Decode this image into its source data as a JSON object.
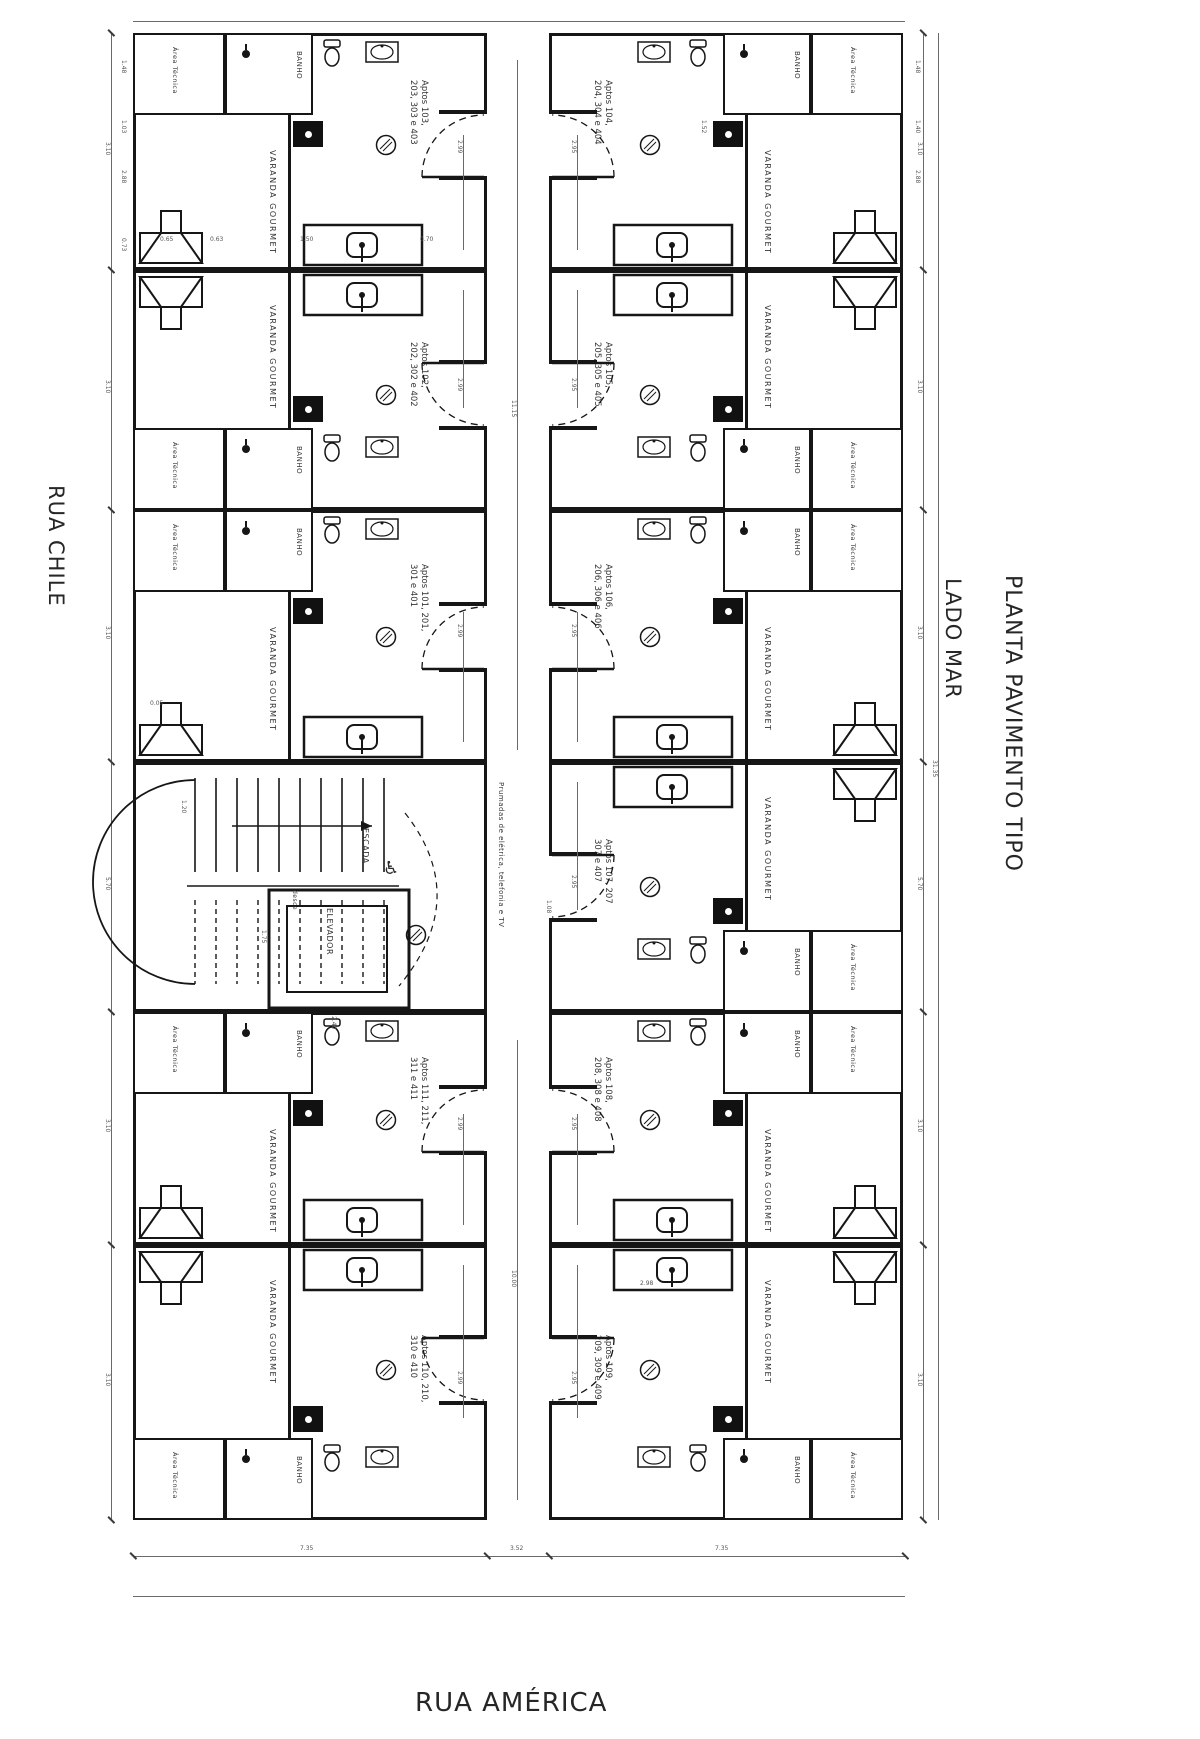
{
  "title": "PLANTA PAVIMENTO TIPO",
  "streets": {
    "left": "RUA CHILE",
    "bottom": "RUA AMÉRICA",
    "sea_side": "LADO MAR"
  },
  "rooms": {
    "varanda": "VARANDA GOURMET",
    "banho": "BANHO",
    "area_tecnica": "Área Técnica"
  },
  "core": {
    "stair": "ESCADA",
    "stair_note": "desce",
    "elevator": "ELEVADOR",
    "riser_note": "Prumadas de elétrica, telefonia e TV",
    "wheelchair_icon": "♿"
  },
  "units": [
    {
      "id": "apt-103",
      "line1": "Aptos 103,",
      "line2": "203, 303 e 403"
    },
    {
      "id": "apt-102",
      "line1": "Aptos 102,",
      "line2": "202, 302 e 402"
    },
    {
      "id": "apt-101",
      "line1": "Aptos 101, 201,",
      "line2": "301 e 401"
    },
    {
      "id": "apt-111",
      "line1": "Aptos 111, 211,",
      "line2": "311 e 411"
    },
    {
      "id": "apt-110",
      "line1": "Aptos 110, 210,",
      "line2": "310 e 410"
    },
    {
      "id": "apt-104",
      "line1": "Aptos 104,",
      "line2": "204, 304 e 404"
    },
    {
      "id": "apt-105",
      "line1": "Aptos 105,",
      "line2": "205, 305 e 405"
    },
    {
      "id": "apt-106",
      "line1": "Aptos 106,",
      "line2": "206, 306 e 406"
    },
    {
      "id": "apt-107",
      "line1": "Aptos 107, 207",
      "line2": "307 e 407"
    },
    {
      "id": "apt-108",
      "line1": "Aptos 108,",
      "line2": "208, 308 e 408"
    },
    {
      "id": "apt-109",
      "line1": "Aptos 109,",
      "line2": "209, 309 e 409"
    }
  ],
  "dims": {
    "unit_row": "3.10",
    "varanda_len": "2.88",
    "varanda_w": "2.99",
    "varanda_w_right": "2.95",
    "service_h": "1.48",
    "shaft_h": "1.03",
    "banho_w": "1.52",
    "tec_w": "1.40",
    "counter": "1.50",
    "counter_gap": "0.70",
    "grill_a": "0.63",
    "grill_b": "0.65",
    "step": "0.73",
    "landing": "0.05",
    "stair_w": "1.20",
    "elev_w": "2.40",
    "elev_d": "1.75",
    "core_h": "5.70",
    "note_dim": "1.08",
    "mid_dim": "2.98",
    "corridor_len_a": "11.15",
    "corridor_len_b": "10.00",
    "overall": "31.35",
    "bottom_side": "7.35",
    "bottom_mid": "3.52"
  },
  "colors": {
    "line": "#161616",
    "dimline": "#6a6a6a",
    "background": "#ffffff"
  }
}
